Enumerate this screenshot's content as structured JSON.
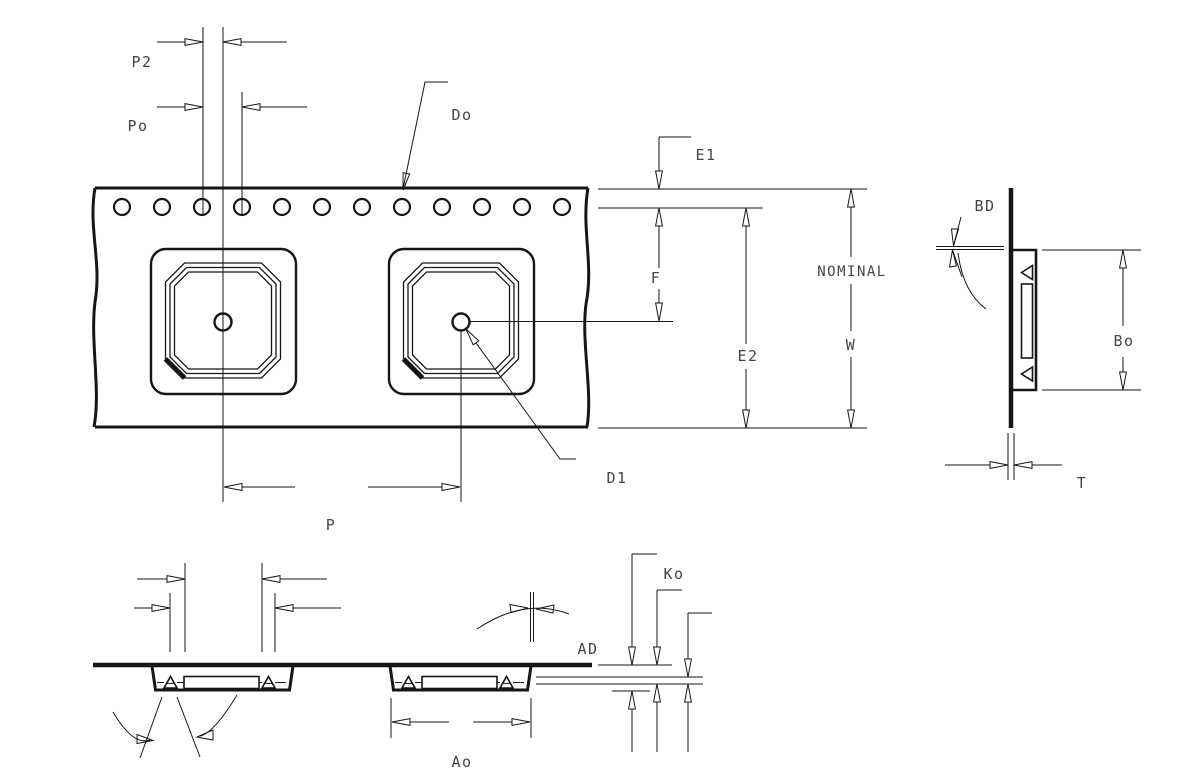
{
  "drawing": {
    "title": "Carrier tape dimension drawing",
    "background_color": "#ffffff",
    "line_color": "#161616",
    "text_color": "#454545",
    "sprocket_hole_count": 12,
    "pocket_count_top_view": 2,
    "pocket_count_section_view": 2
  },
  "labels": {
    "p2": "P2",
    "po": "Po",
    "do": "Do",
    "e1": "E1",
    "nominal": "NOMINAL",
    "f": "F",
    "e2": "E2",
    "w": "W",
    "d1": "D1",
    "p": "P",
    "bd": "BD",
    "bo": "Bo",
    "t": "T",
    "ko": "Ko",
    "ad": "AD",
    "ao": "Ao"
  }
}
